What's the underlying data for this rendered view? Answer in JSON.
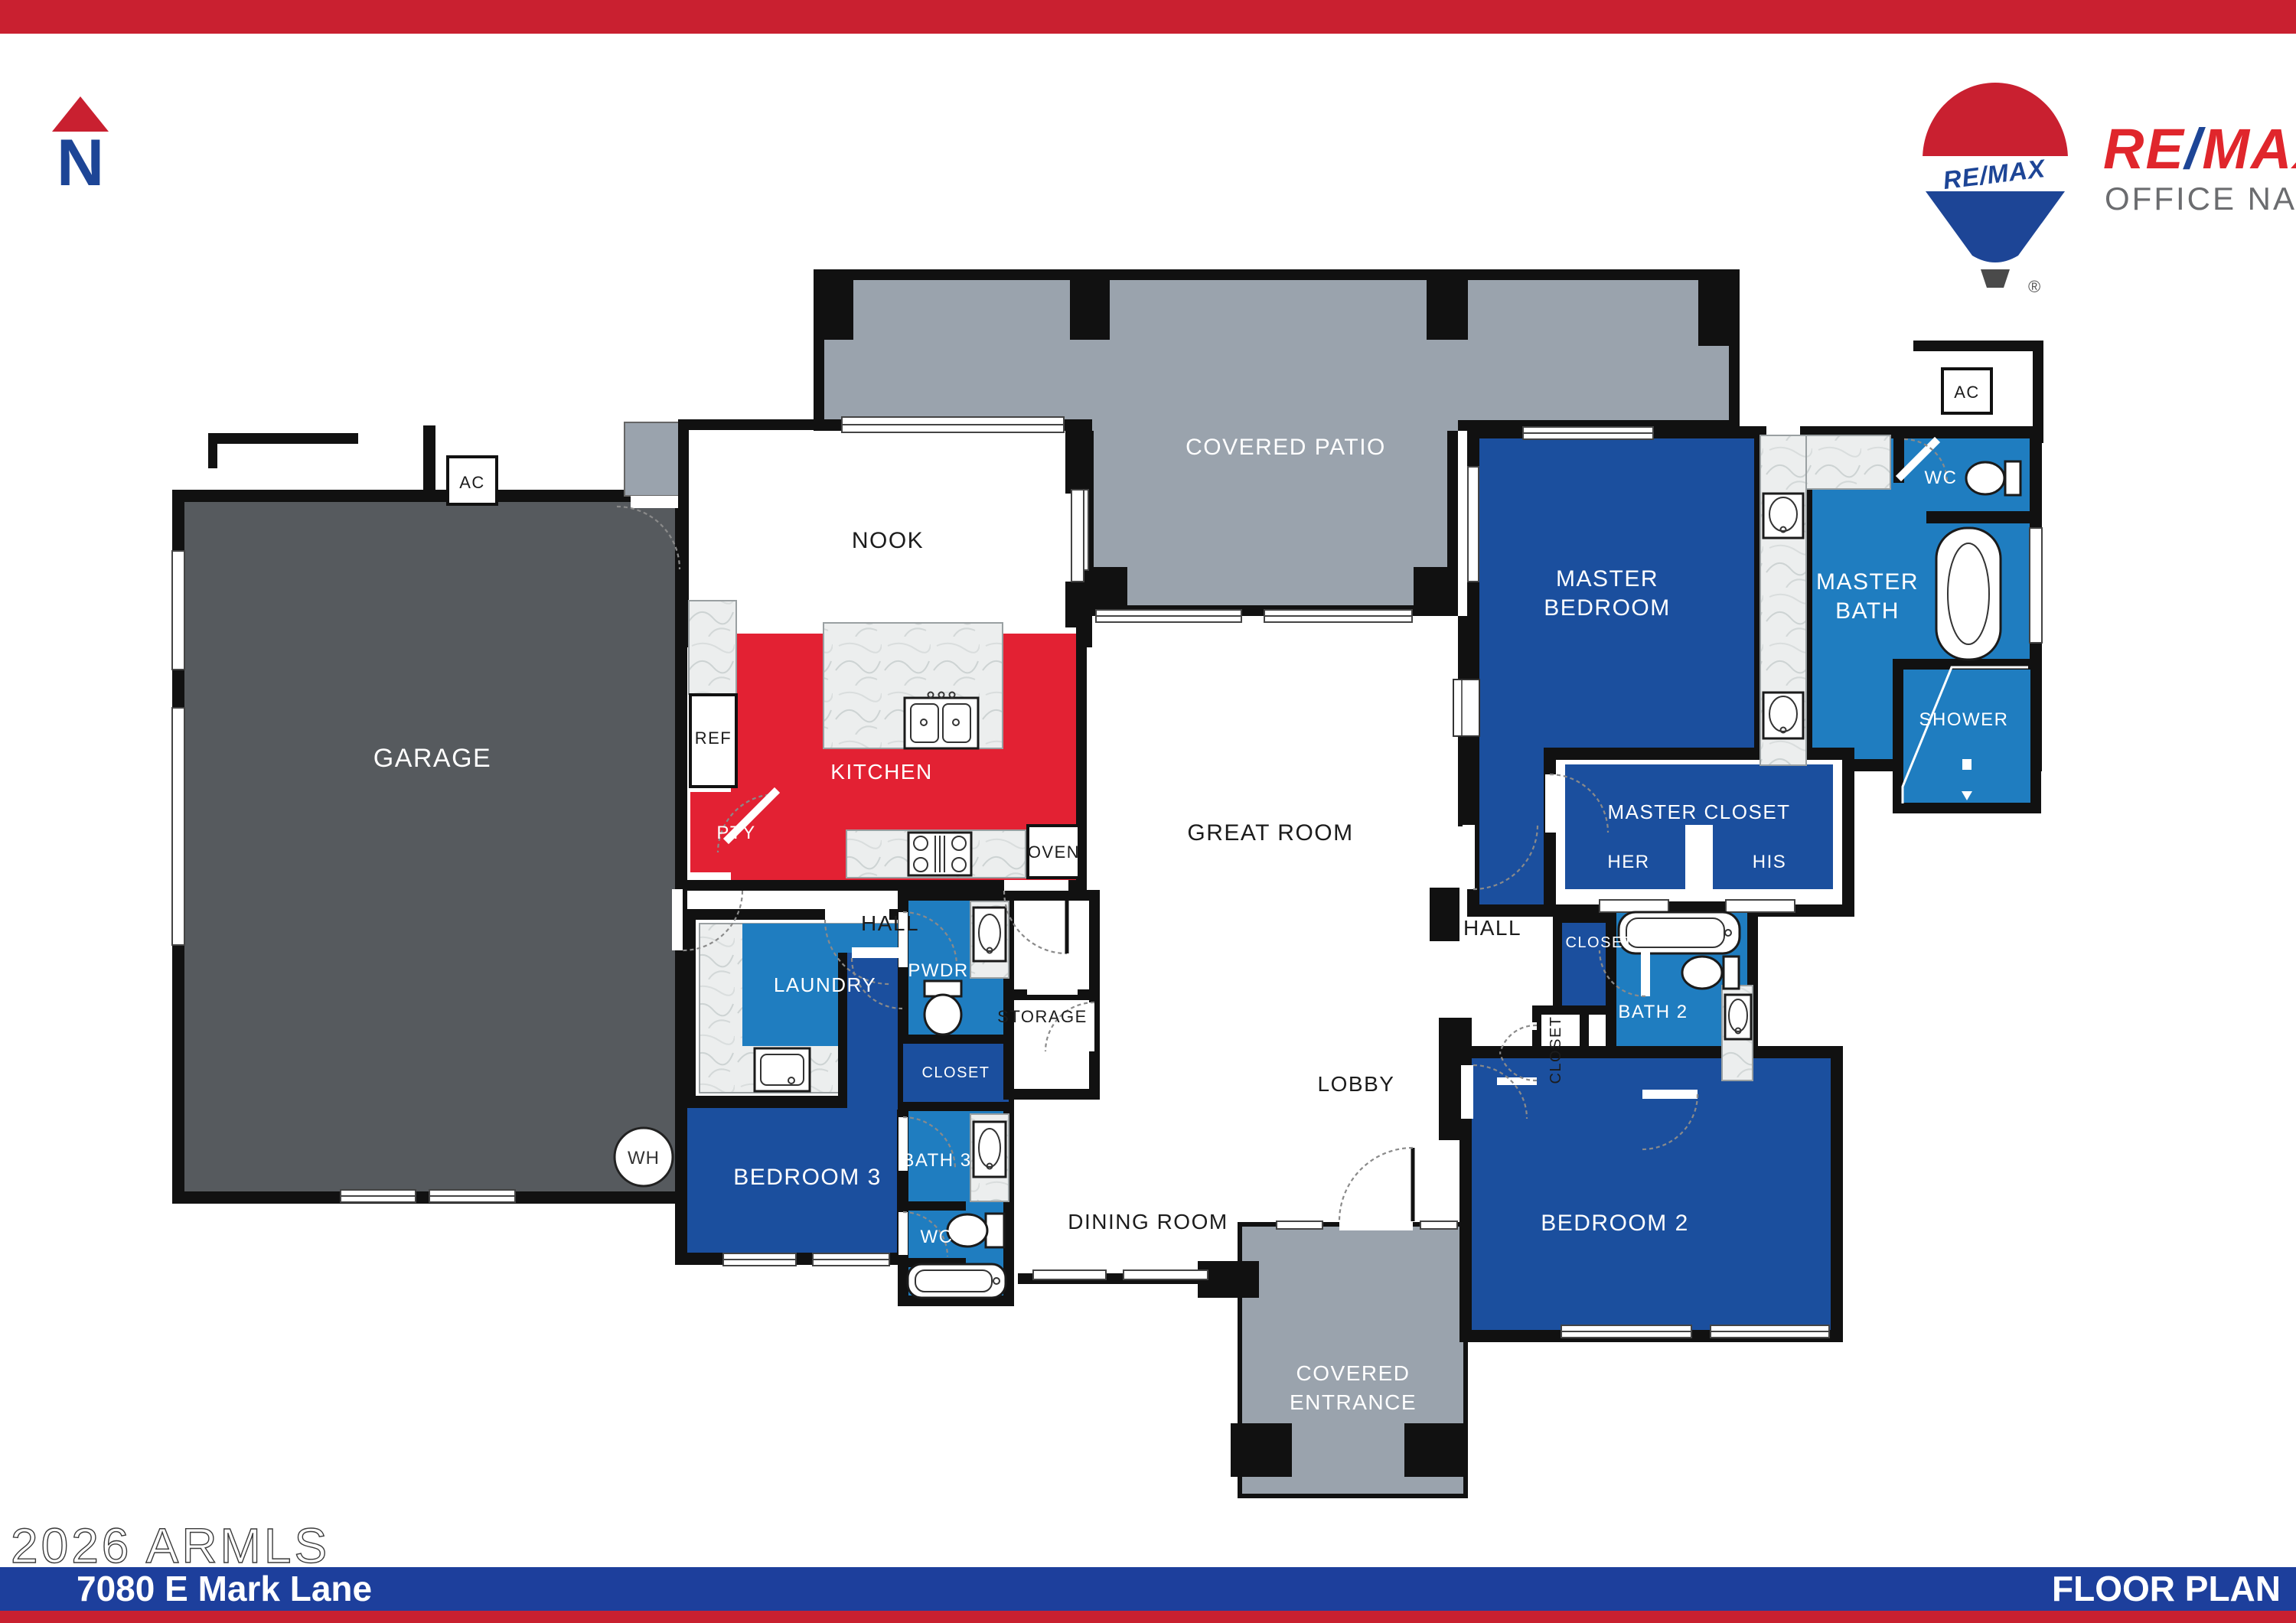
{
  "header": {
    "north_letter": "N",
    "balloon_text": "RE/MAX",
    "brand_re": "RE",
    "brand_slash": "/",
    "brand_max": "MAX",
    "office_name": "OFFICE NAME",
    "registered": "®"
  },
  "footer": {
    "watermark": "2026 ARMLS",
    "address": "7080 E Mark Lane",
    "plan_label": "FLOOR PLAN"
  },
  "colors": {
    "banner_red": "#c92030",
    "brand_blue": "#1d4596",
    "room_blue": "#1b4f9e",
    "bath_blue": "#1f7dc0",
    "kitchen_red": "#e32133",
    "patio_gray": "#9aa3ad",
    "garage_gray": "#565a5e",
    "footer_blue": "#1d3f9c"
  },
  "rooms": {
    "covered_patio": "COVERED PATIO",
    "nook": "NOOK",
    "garage": "GARAGE",
    "kitchen": "KITCHEN",
    "hall_left": "HALL",
    "hall_right": "HALL",
    "laundry": "LAUNDRY",
    "pwdr": "PWDR",
    "closet_coat": "CLOSET",
    "storage": "STORAGE",
    "closet_bed3": "CLOSET",
    "bath3": "BATH 3",
    "wc_bed3": "WC",
    "bedroom3": "BEDROOM 3",
    "dining": "DINING ROOM",
    "great_room": "GREAT ROOM",
    "lobby": "LOBBY",
    "covered_entrance_line1": "COVERED",
    "covered_entrance_line2": "ENTRANCE",
    "bedroom2": "BEDROOM 2",
    "bath2": "BATH 2",
    "closet_bed2": "CLOSET",
    "closet_entry": "CLOSET",
    "master_bedroom_line1": "MASTER",
    "master_bedroom_line2": "BEDROOM",
    "master_bath_line1": "MASTER",
    "master_bath_line2": "BATH",
    "master_closet": "MASTER CLOSET",
    "her": "HER",
    "his": "HIS",
    "shower": "SHOWER",
    "wc_master": "WC"
  },
  "fixtures": {
    "ref": "REF",
    "pty": "PTY",
    "oven": "OVEN",
    "ac_garage": "AC",
    "ac_master": "AC",
    "wh": "WH"
  }
}
